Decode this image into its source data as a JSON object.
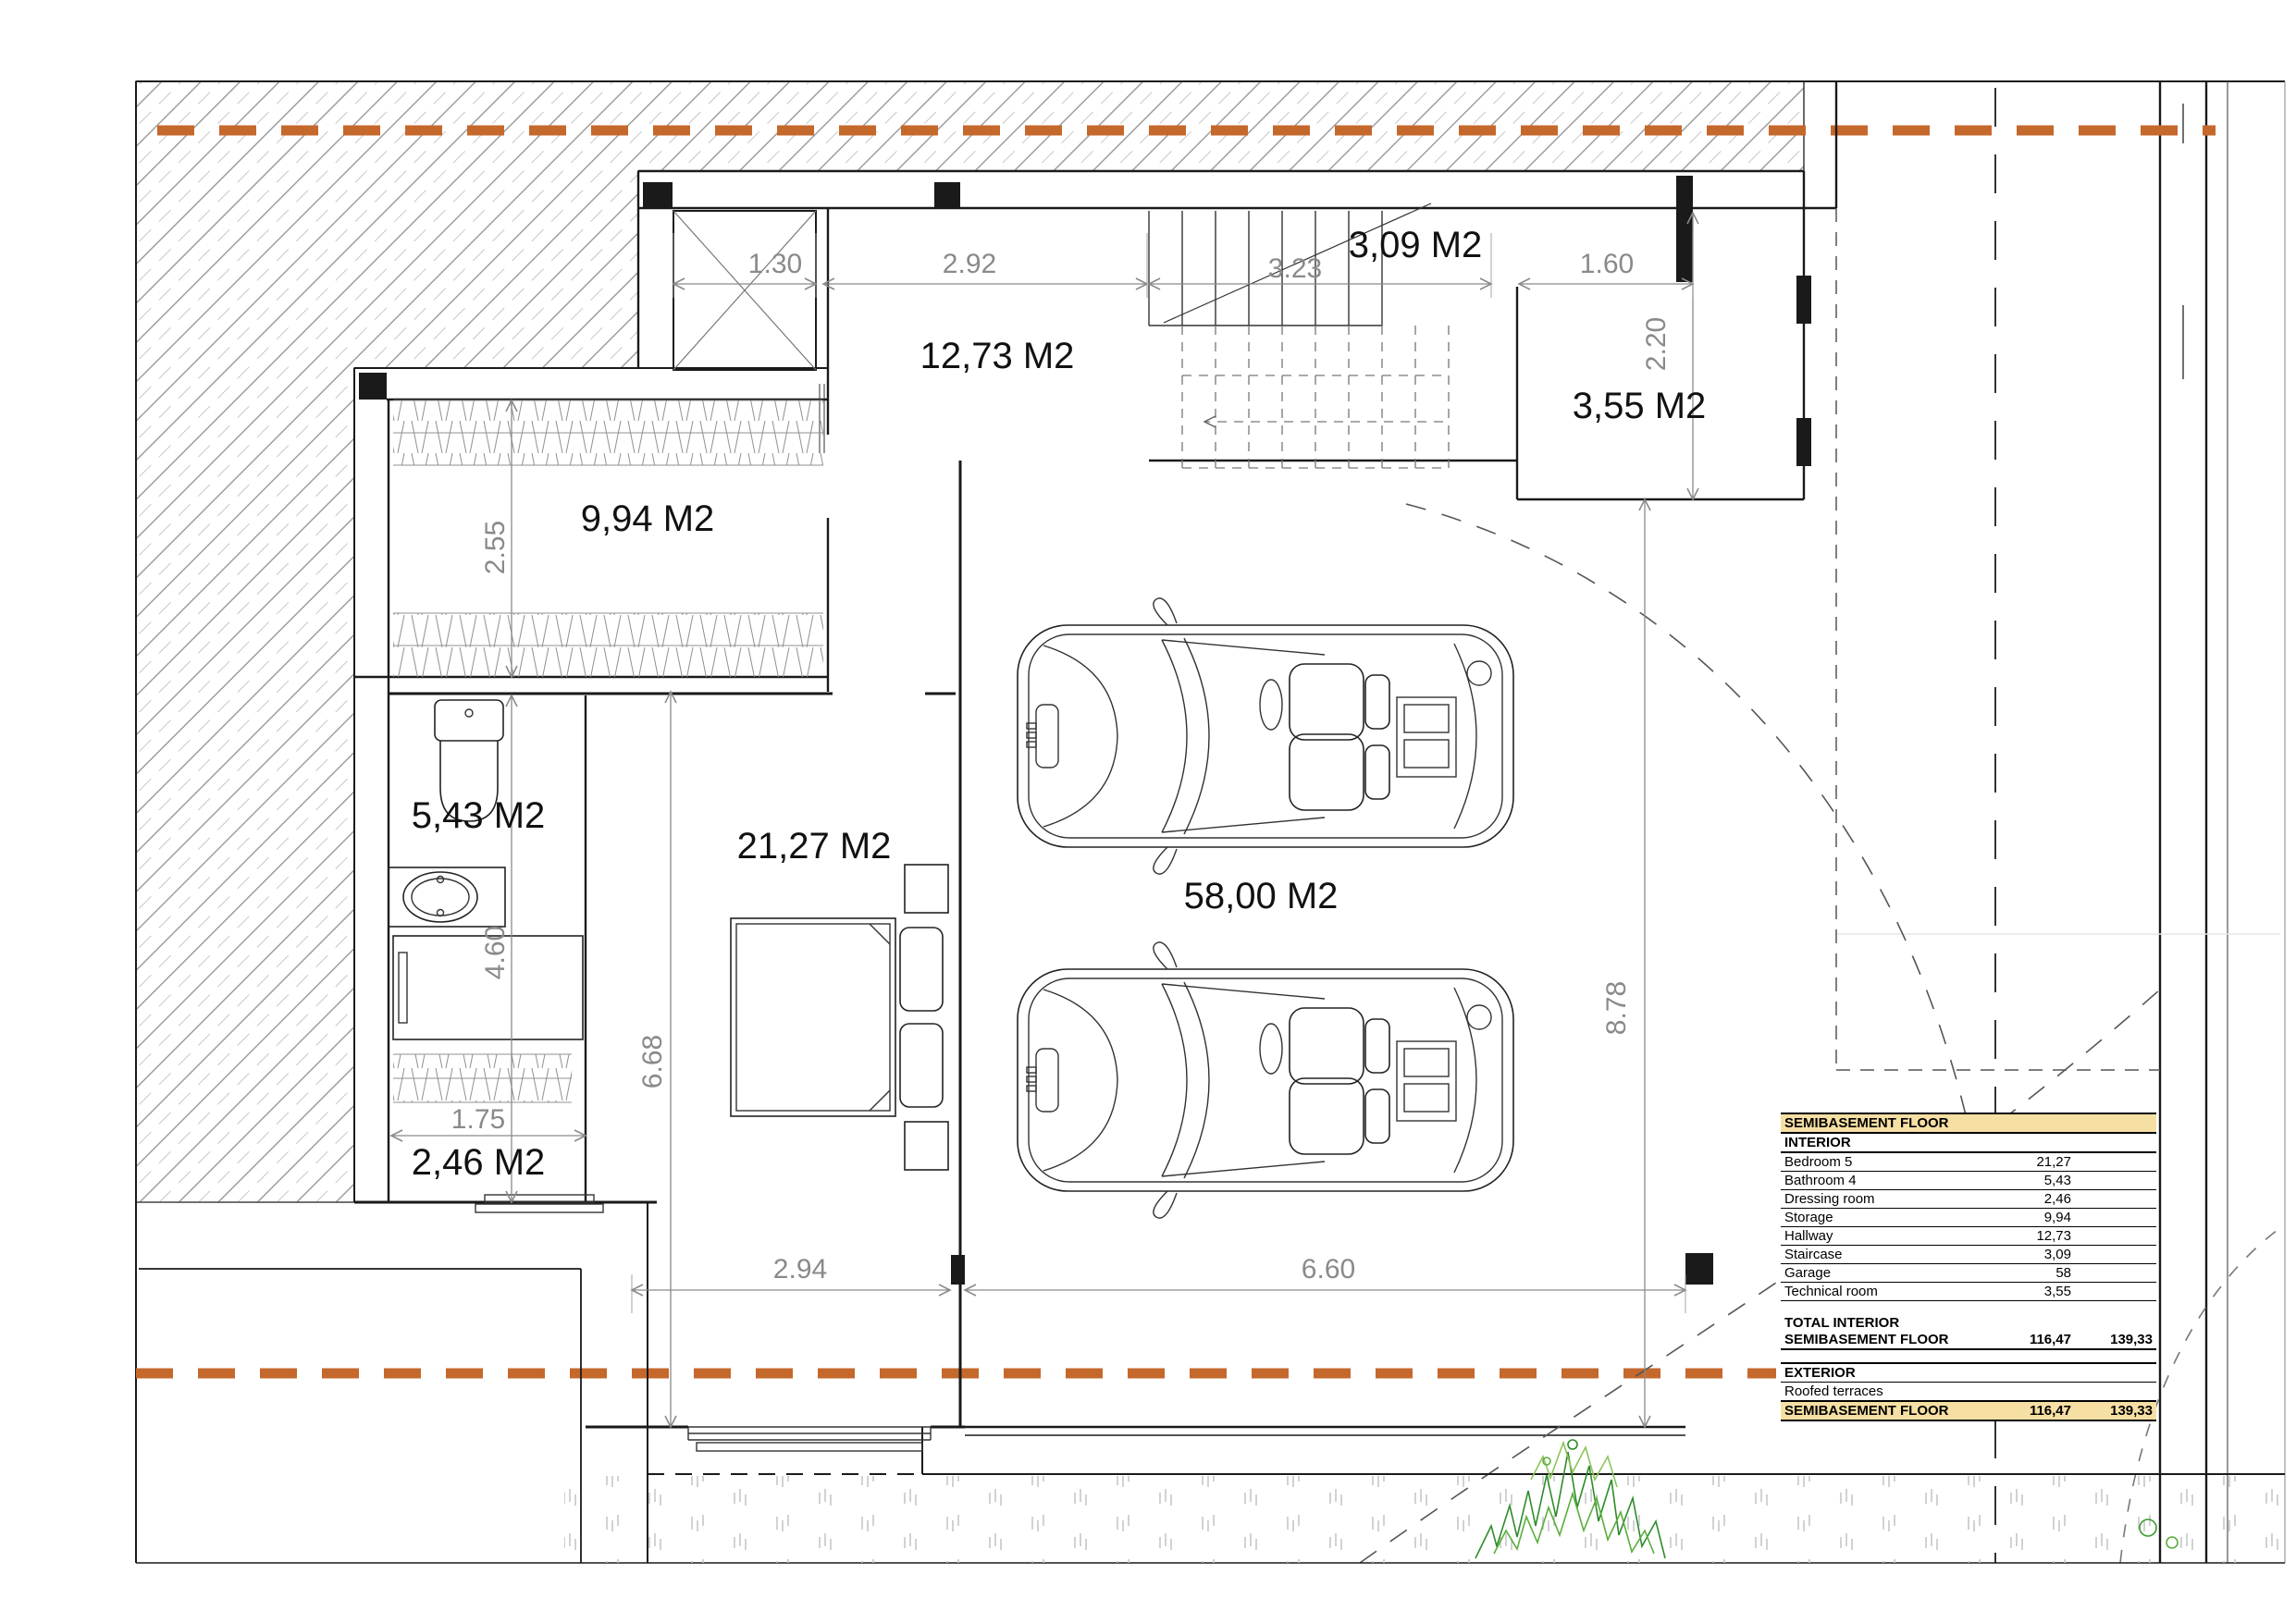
{
  "colors": {
    "section_line_orange": "#C5682C",
    "table_header_bg": "#F6DFA3",
    "dimension_gray": "#8a8a8a",
    "plant_green": "#2e8b2b"
  },
  "rooms": {
    "staircase": "3,09 M2",
    "hallway": "12,73 M2",
    "technical_room": "3,55 M2",
    "storage": "9,94 M2",
    "bathroom": "5,43 M2",
    "bedroom": "21,27 M2",
    "dressing_room": "2,46 M2",
    "garage": "58,00 M2"
  },
  "dimensions": {
    "d130": "1.30",
    "d292": "2.92",
    "d323": "3.23",
    "d160": "1.60",
    "d220": "2.20",
    "d255": "2.55",
    "d460": "4.60",
    "d668": "6.68",
    "d175": "1.75",
    "d294": "2.94",
    "d660": "6.60",
    "d878": "8.78"
  },
  "table": {
    "title": "SEMIBASEMENT FLOOR",
    "interior_heading": "INTERIOR",
    "rows": [
      {
        "label": "Bedroom 5",
        "value": "21,27"
      },
      {
        "label": "Bathroom 4",
        "value": "5,43"
      },
      {
        "label": "Dressing room",
        "value": "2,46"
      },
      {
        "label": "Storage",
        "value": "9,94"
      },
      {
        "label": "Hallway",
        "value": "12,73"
      },
      {
        "label": "Staircase",
        "value": "3,09"
      },
      {
        "label": "Garage",
        "value": "58"
      },
      {
        "label": "Technical room",
        "value": "3,55"
      }
    ],
    "total_label_line1": "TOTAL INTERIOR",
    "total_label_line2": "SEMIBASEMENT FLOOR",
    "total_value1": "116,47",
    "total_value2": "139,33",
    "exterior_heading": "EXTERIOR",
    "exterior_row_label": "Roofed terraces",
    "footer_label": "SEMIBASEMENT FLOOR",
    "footer_value1": "116,47",
    "footer_value2": "139,33"
  }
}
